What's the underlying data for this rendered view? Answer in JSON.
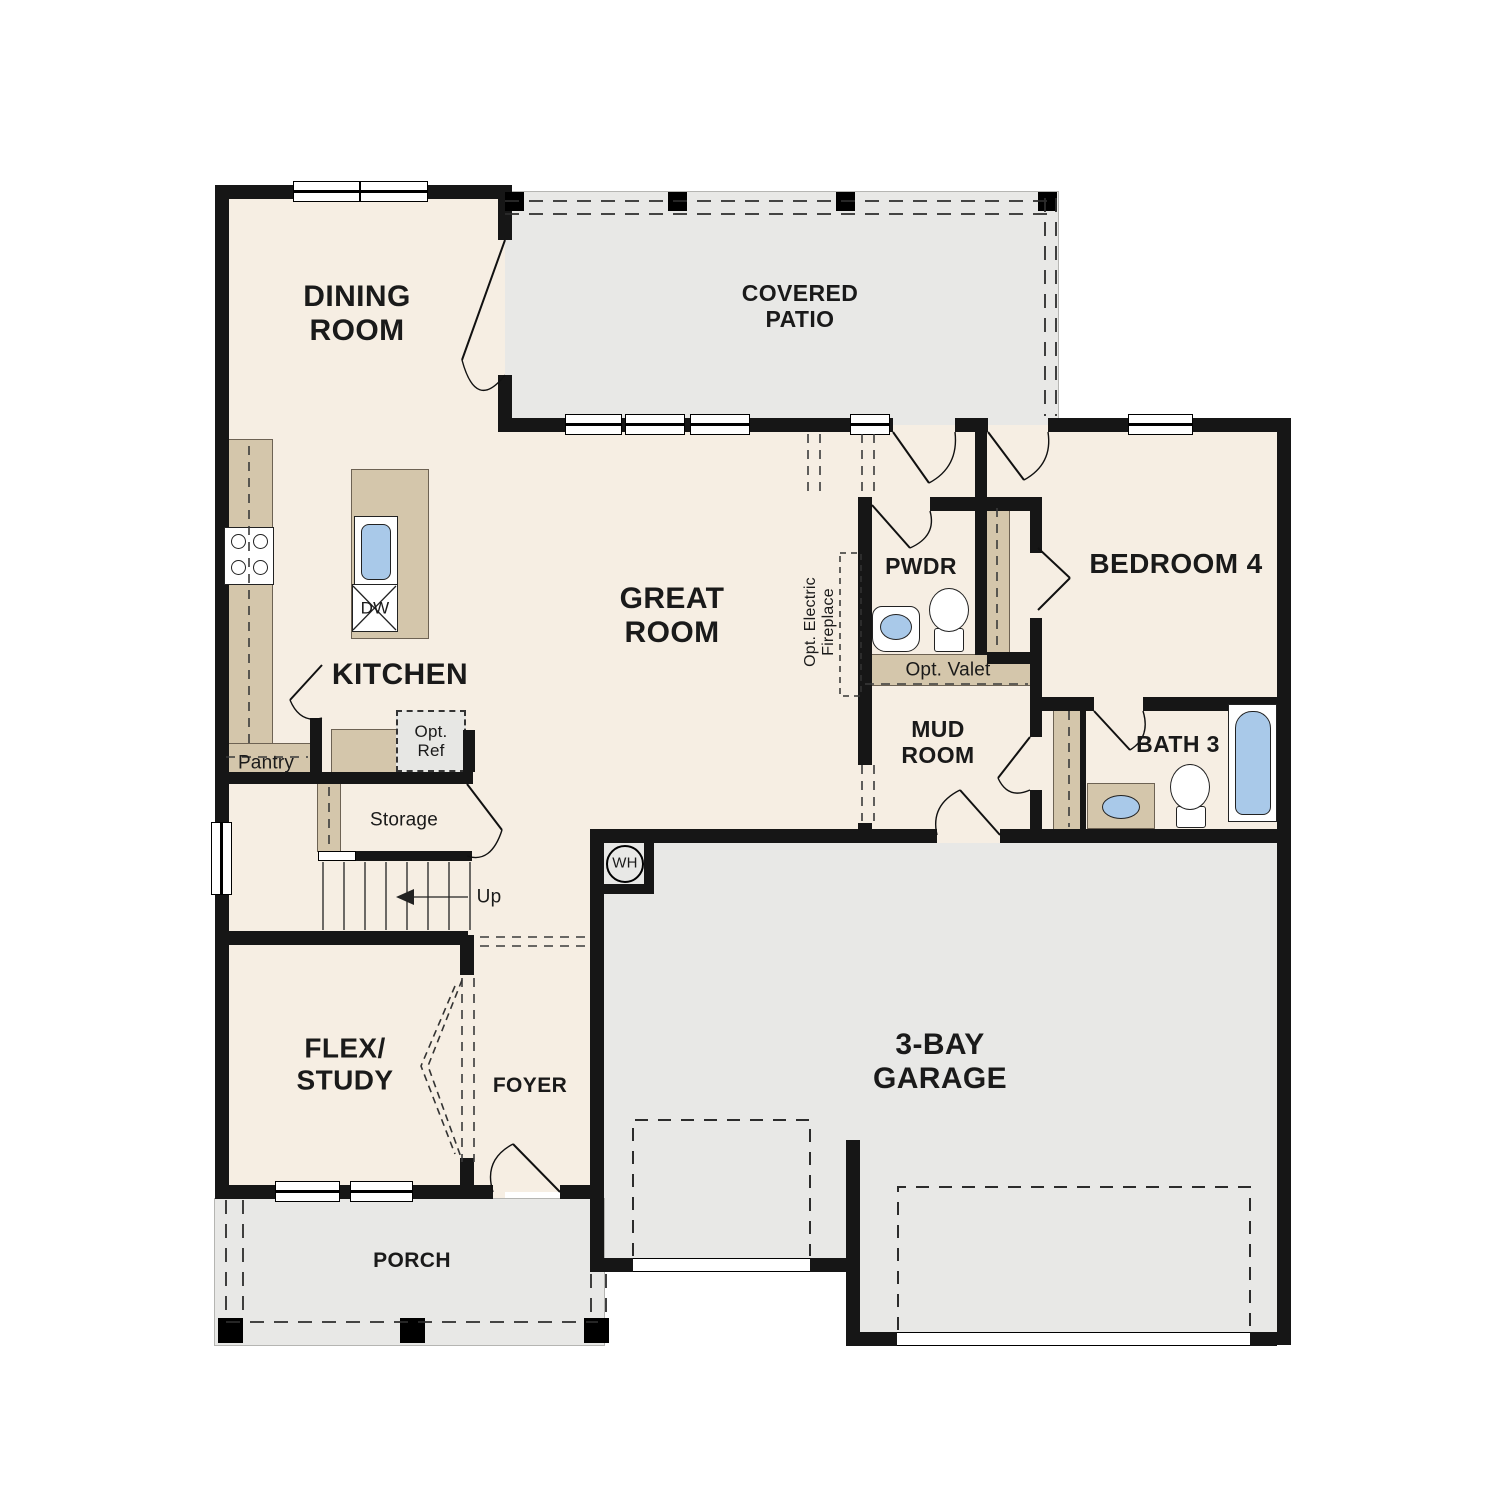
{
  "meta": {
    "title": "First floor plan",
    "type": "residential-floor-plan"
  },
  "colors": {
    "floor": "#f6eee3",
    "outdoor": "#e8e8e6",
    "cabinet": "#d4c6ab",
    "wall": "#161616",
    "fixture": "#a9c9e9"
  },
  "rooms": {
    "dining": {
      "label": "DINING\nROOM"
    },
    "covered_patio": {
      "label": "COVERED\nPATIO"
    },
    "great_room": {
      "label": "GREAT\nROOM"
    },
    "kitchen": {
      "label": "KITCHEN"
    },
    "powder": {
      "label": "PWDR"
    },
    "bedroom4": {
      "label": "BEDROOM 4"
    },
    "mud_room": {
      "label": "MUD\nROOM"
    },
    "bath3": {
      "label": "BATH 3"
    },
    "flex_study": {
      "label": "FLEX/\nSTUDY"
    },
    "foyer": {
      "label": "FOYER"
    },
    "porch": {
      "label": "PORCH"
    },
    "garage": {
      "label": "3-BAY\nGARAGE"
    }
  },
  "annotations": {
    "pantry": "Pantry",
    "opt_ref": "Opt.\nRef",
    "storage": "Storage",
    "up": "Up",
    "dw": "DW",
    "wh": "WH",
    "opt_valet": "Opt. Valet",
    "opt_fireplace": "Opt. Electric\nFireplace"
  }
}
